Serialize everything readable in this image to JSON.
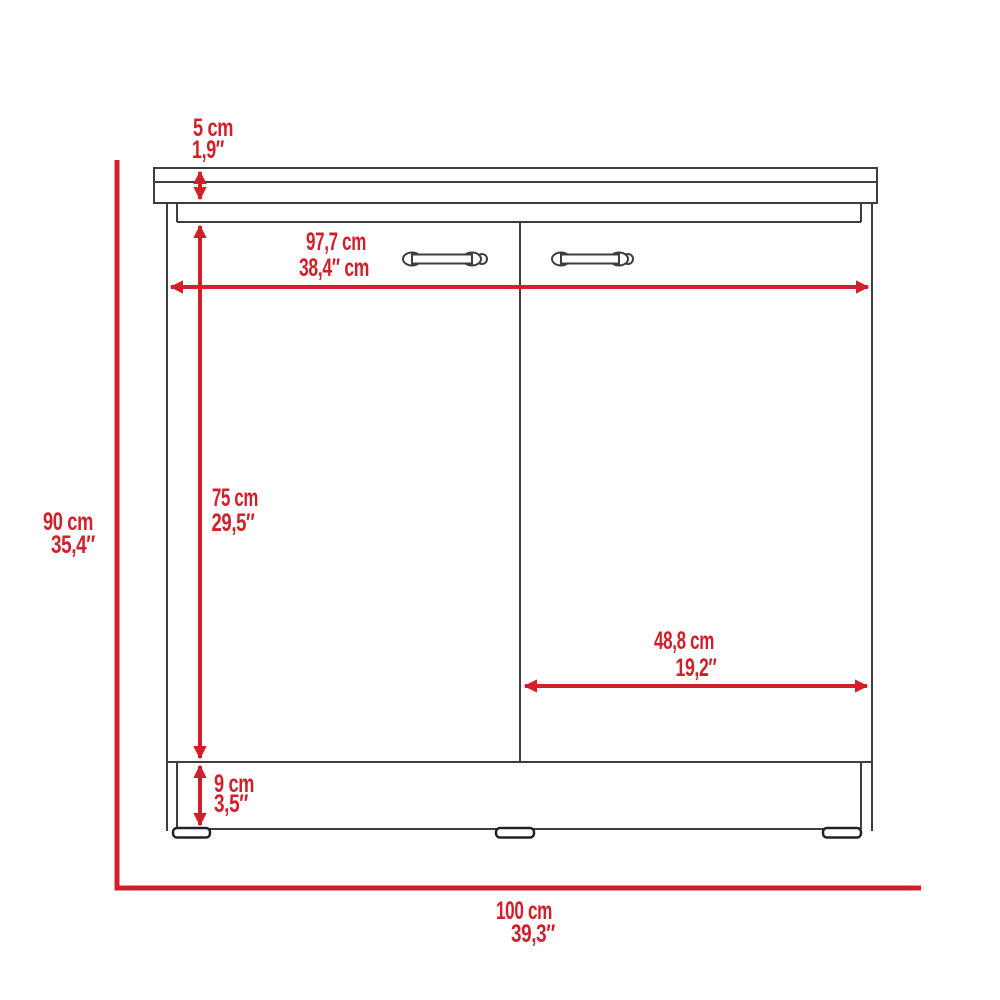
{
  "diagram": {
    "title": "base-cabinet-dimension-drawing",
    "object": "two-door base cabinet with countertop and plinth",
    "accent_color": "#d2202a",
    "line_color": "#3e3e42",
    "dimensions": [
      {
        "id": "countertop-thickness",
        "cm": "5 cm",
        "inches": "1,9″"
      },
      {
        "id": "carcass-width",
        "cm": "97,7 cm",
        "inches": "38,4″ cm"
      },
      {
        "id": "overall-height",
        "cm": "90 cm",
        "inches": "35,4″"
      },
      {
        "id": "door-height",
        "cm": "75 cm",
        "inches": "29,5″"
      },
      {
        "id": "door-width",
        "cm": "48,8 cm",
        "inches": "19,2″"
      },
      {
        "id": "plinth-height",
        "cm": "9 cm",
        "inches": "3,5″"
      },
      {
        "id": "overall-width",
        "cm": "100 cm",
        "inches": "39,3″"
      }
    ]
  }
}
